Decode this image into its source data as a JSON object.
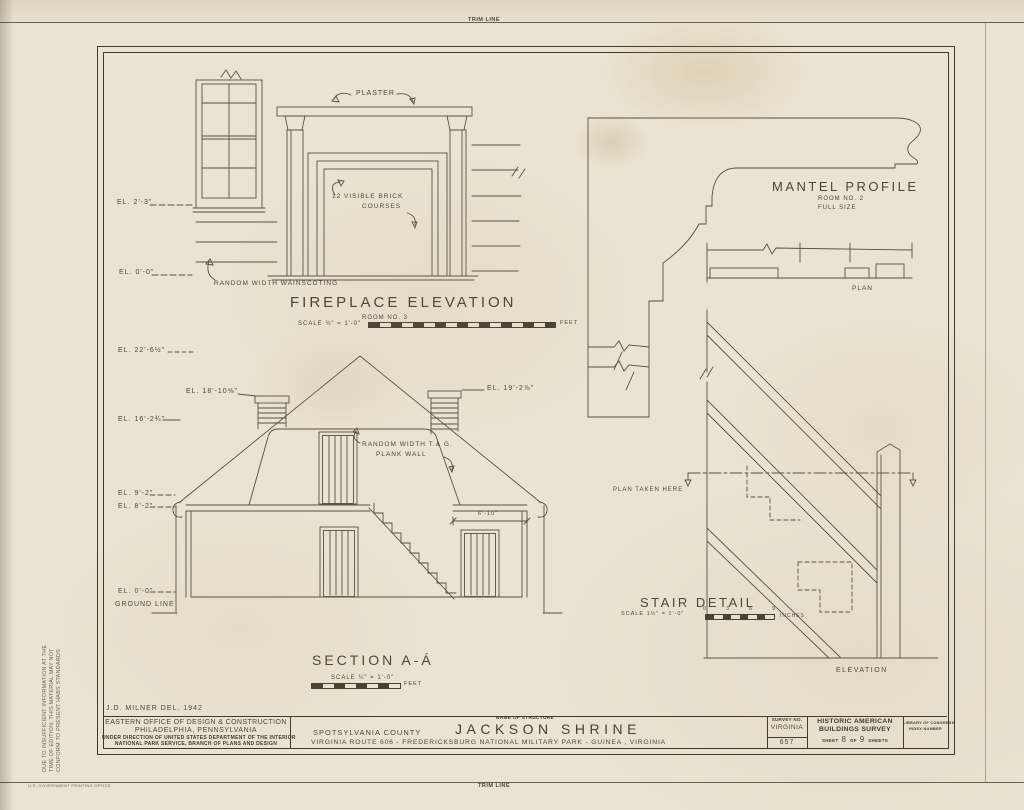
{
  "sheet": {
    "trim_top": "TRIM LINE",
    "trim_bottom": "TRIM LINE",
    "printer_mark": "U.S. GOVERNMENT PRINTING OFFICE",
    "margin_note_line1": "DUE TO INSUFFICIENT INFORMATION AT THE",
    "margin_note_line2": "TIME OF EDITION, THIS MATERIAL MAY NOT",
    "margin_note_line3": "CONFORM TO PRESENT HABS STANDARDS"
  },
  "fireplace": {
    "label_plaster": "PLASTER",
    "label_brick_line1": "12 VISIBLE BRICK",
    "label_brick_line2": "COURSES",
    "el_top": "EL. 2'-3\"",
    "el_bottom": "EL. 0'-0\"",
    "label_wainscoting": "RANDOM WIDTH WAINSCOTING",
    "title": "FIREPLACE ELEVATION",
    "room": "ROOM NO. 3",
    "scale": "SCALE ¾\" = 1'-0\"",
    "unit": "FEET"
  },
  "mantel": {
    "title": "MANTEL PROFILE",
    "room": "ROOM NO. 2",
    "size": "FULL SIZE",
    "plan": "PLAN"
  },
  "section": {
    "title": "SECTION A-Á",
    "scale": "SCALE ¼\" = 1'-0\"",
    "unit": "FEET",
    "el_ridge": "EL. 22'-6½\"",
    "el_chimney_left": "EL. 18'-10⅝\"",
    "el_chimney_right": "EL. 19'-2⅞\"",
    "el_attic": "EL. 16'-2¾\"",
    "el_ceiling": "EL. 9'-2\"",
    "el_plate": "EL. 8'-2\"",
    "el_floor": "EL. 0'-0\"",
    "ground": "GROUND LINE",
    "label_plank_line1": "RANDOM WIDTH T.& G.",
    "label_plank_line2": "PLANK WALL",
    "dim_closet": "6'-10\""
  },
  "stair": {
    "title": "STAIR DETAIL",
    "scale": "SCALE 1½\" = 1'-0\"",
    "unit": "INCHES",
    "ticks": [
      "0",
      "3",
      "6",
      "9"
    ],
    "label_plan_cut": "PLAN TAKEN HERE",
    "label_elevation": "ELEVATION"
  },
  "titleblock": {
    "delineator": "J.D. MILNER   DEL.   1942",
    "office1": "EASTERN OFFICE OF DESIGN & CONSTRUCTION",
    "office2": "PHILADELPHIA, PENNSYLVANIA",
    "office3": "UNDER DIRECTION OF UNITED STATES DEPARTMENT OF THE INTERIOR",
    "office4": "NATIONAL PARK SERVICE, BRANCH OF PLANS AND DESIGN",
    "county": "SPOTSYLVANIA COUNTY",
    "name_caption": "NAME OF STRUCTURE",
    "structure": "JACKSON SHRINE",
    "location": "VIRGINIA ROUTE 606 - FREDERICKSBURG NATIONAL MILITARY PARK - GUINEA , VIRGINIA",
    "survey_caption": "SURVEY NO.",
    "survey_state": "VIRGINIA",
    "survey_no": "657",
    "habs1": "HISTORIC AMERICAN",
    "habs2": "BUILDINGS SURVEY",
    "sheet_word": "SHEET",
    "sheet_no": "8",
    "of_word": "OF",
    "sheet_total": "9",
    "sheets_word": "SHEETS",
    "loc1": "LIBRARY OF CONGRESS",
    "loc2": "INDEX NUMBER"
  }
}
